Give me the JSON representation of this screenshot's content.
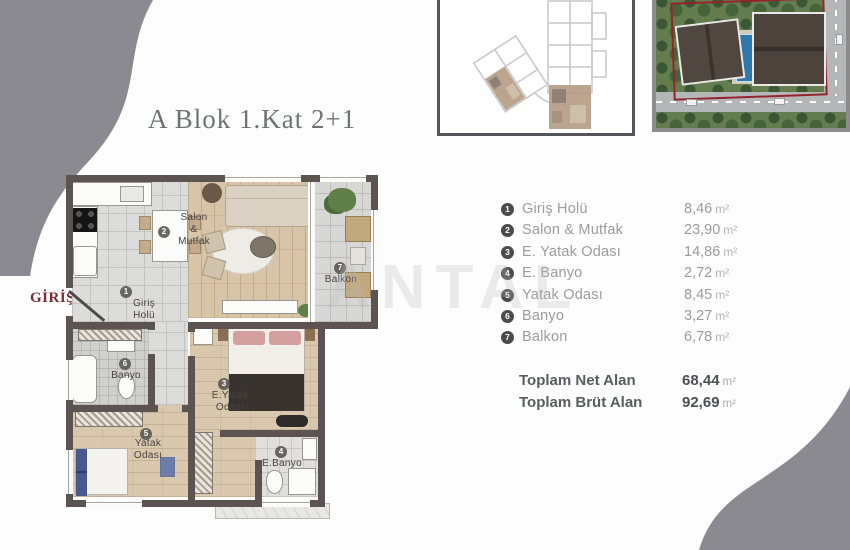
{
  "title": "A Blok 1.Kat 2+1",
  "entry": {
    "label": "GİRİŞ",
    "arrow": "➤"
  },
  "watermark": "ANTAL",
  "plan_rooms": {
    "giris": {
      "num": "1",
      "line1": "Giriş",
      "line2": "Holü"
    },
    "salon": {
      "num": "2",
      "line1": "Salon",
      "line2": "&",
      "line3": "Mutfak"
    },
    "eyatak": {
      "num": "3",
      "line1": "E.Yatak",
      "line2": "Odası"
    },
    "ebanyo": {
      "num": "4",
      "line1": "E.Banyo"
    },
    "yatak": {
      "num": "5",
      "line1": "Yatak",
      "line2": "Odası"
    },
    "banyo": {
      "num": "6",
      "line1": "Banyo"
    },
    "balkon": {
      "num": "7",
      "line1": "Balkon"
    }
  },
  "legend": {
    "rows": [
      {
        "num": "1",
        "label": "Giriş Holü",
        "value": "8,46",
        "unit": "m²"
      },
      {
        "num": "2",
        "label": "Salon & Mutfak",
        "value": "23,90",
        "unit": "m²"
      },
      {
        "num": "3",
        "label": "E. Yatak Odası",
        "value": "14,86",
        "unit": "m²"
      },
      {
        "num": "4",
        "label": "E. Banyo",
        "value": "2,72",
        "unit": "m²"
      },
      {
        "num": "5",
        "label": "Yatak Odası",
        "value": "8,45",
        "unit": "m²"
      },
      {
        "num": "6",
        "label": "Banyo",
        "value": "3,27",
        "unit": "m²"
      },
      {
        "num": "7",
        "label": "Balkon",
        "value": "6,78",
        "unit": "m²"
      }
    ],
    "totals": [
      {
        "label": "Toplam Net Alan",
        "value": "68,44",
        "unit": "m²"
      },
      {
        "label": "Toplam Brüt Alan",
        "value": "92,69",
        "unit": "m²"
      }
    ]
  },
  "colors": {
    "accent_maroon": "#7b2c38",
    "wall": "#5b5452",
    "corner_gray": "#8a8a90"
  }
}
